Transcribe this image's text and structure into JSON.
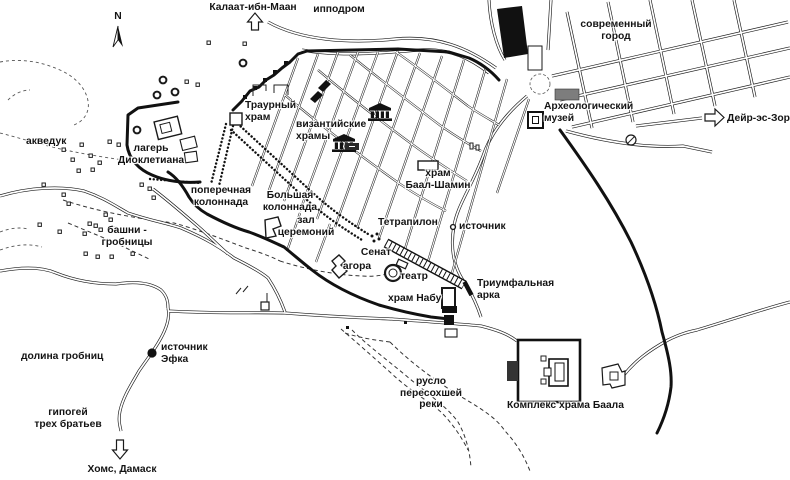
{
  "map_labels": {
    "kalaat": "Калаат-ибн-Маан",
    "hippodrome": "ипподром",
    "modern_city": "современный\nгород",
    "museum": "Археологический\nмузей",
    "deir_ez_zor": "Дейр-эс-Зор",
    "aqueduct": "акведук",
    "diocletian_camp": "лагерь\nДиоклетиана",
    "funerary_temple": "Траурный\nхрам",
    "byzantine_churches": "византийские\nхрамы",
    "baal_shamin": "храм\nБаал-Шамин",
    "transverse_colonnade": "поперечная\nколоннада",
    "great_colonnade": "Большая\nколоннада",
    "ceremony_hall": "зал\nцеремоний",
    "tetrapylon": "Тетрапилон",
    "spring": "источник",
    "tower_tombs": "башни -\nгробницы",
    "senate": "Сенат",
    "agora": "агора",
    "theater": "театр",
    "triumphal_arch": "Триумфальная\nарка",
    "nabu_temple": "храм Набу",
    "tombs_valley": "долина гробниц",
    "efqa_spring": "источник\nЭфка",
    "hypogeum": "гипогей\nтрех братьев",
    "homs_damascus": "Хомс, Дамаск",
    "dry_riverbed": "русло\nпересохшей\nреки",
    "bel_temple": "Комплекс храма Баала",
    "compass_n": "N"
  },
  "icons": {
    "compass": "north-needle-icon",
    "to_kalaat": "up-arrow-icon",
    "to_deir_ez_zor": "right-arrow-icon",
    "to_homs_damascus": "down-arrow-icon",
    "byzantine_church": "temple-facade-icon",
    "efqa_spring": "black-dot-icon",
    "spring_near_tetrapylon": "small-circle-icon",
    "tetrapylon": "four-dots-icon",
    "roundabout": "circle-slash-icon"
  },
  "colors": {
    "ink": "#1a1a1a",
    "museum_fill": "#7d7d7d",
    "paper": "#ffffff"
  }
}
